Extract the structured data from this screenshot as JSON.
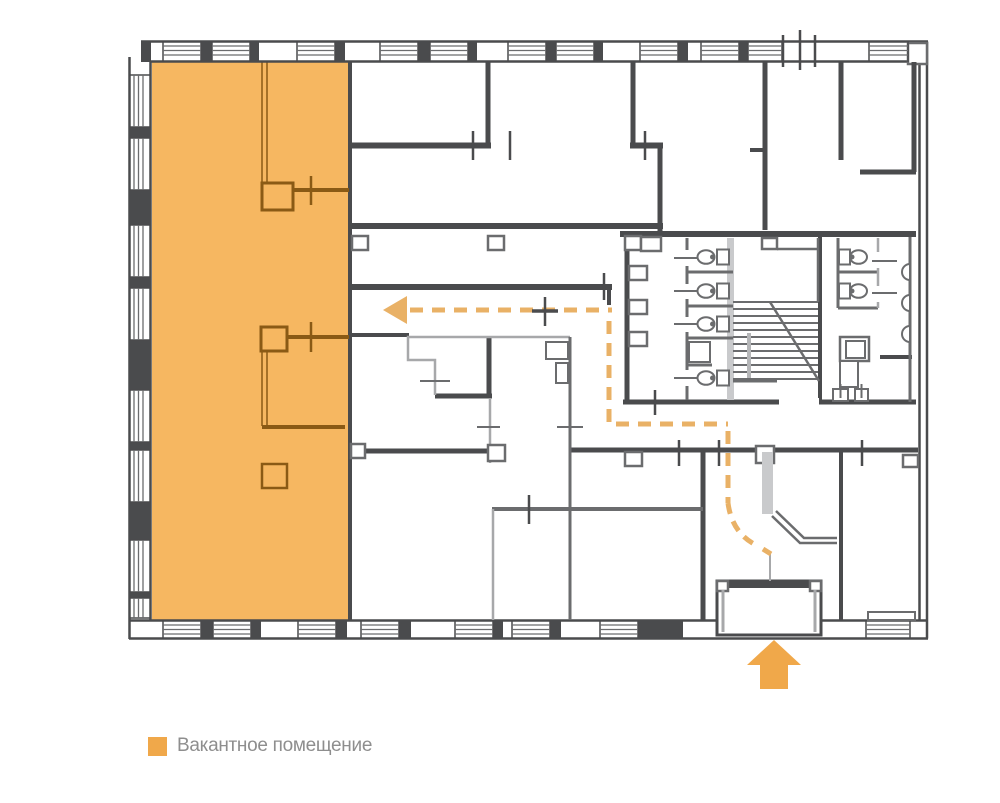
{
  "legend": {
    "items": [
      {
        "label": "Вакантное помещение"
      }
    ]
  },
  "colors": {
    "wall": "#4a4b4d",
    "wall-mid": "#6b6c6e",
    "wall-light": "#a7a8aa",
    "fixture": "#c9cacc",
    "vacant": "#f6b761",
    "vacant-line": "#8a5a15",
    "route": "#e9b166",
    "accent": "#f0a84a",
    "legend-text": "#8e8e8e"
  }
}
